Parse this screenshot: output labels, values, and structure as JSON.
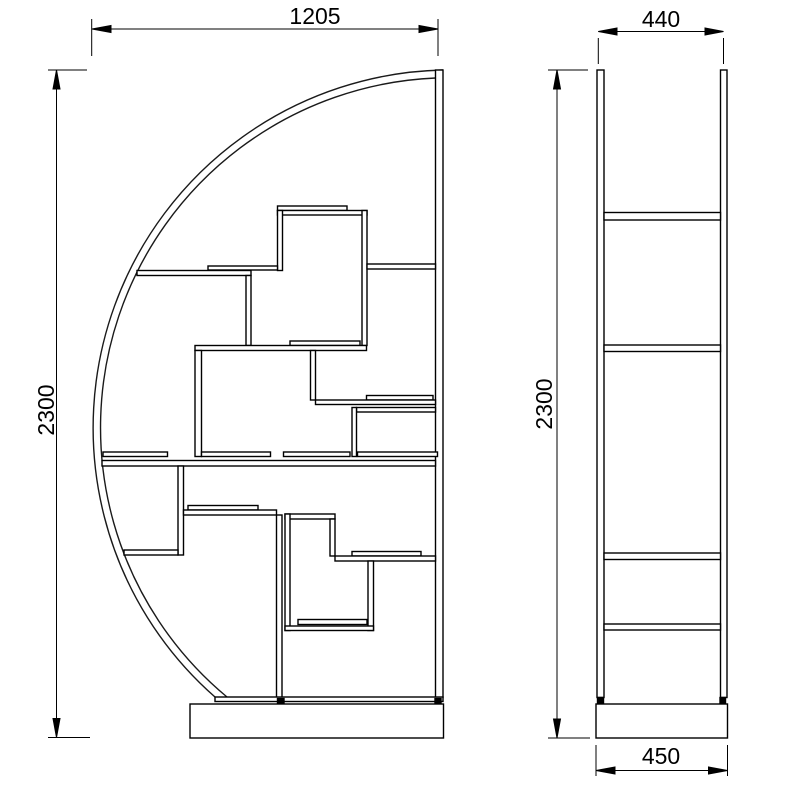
{
  "drawing": {
    "kind": "technical-elevation-drawing",
    "subject": "curved half-moon shelving unit",
    "views": {
      "left": "front-elevation",
      "right": "side-elevation"
    },
    "colors": {
      "line": "#000000",
      "background": "#ffffff",
      "foot_mark": "#000000"
    }
  },
  "dimensions": {
    "front_width": "1205",
    "front_height": "2300",
    "side_depth": "440",
    "side_height": "2300",
    "side_base_depth": "450"
  }
}
